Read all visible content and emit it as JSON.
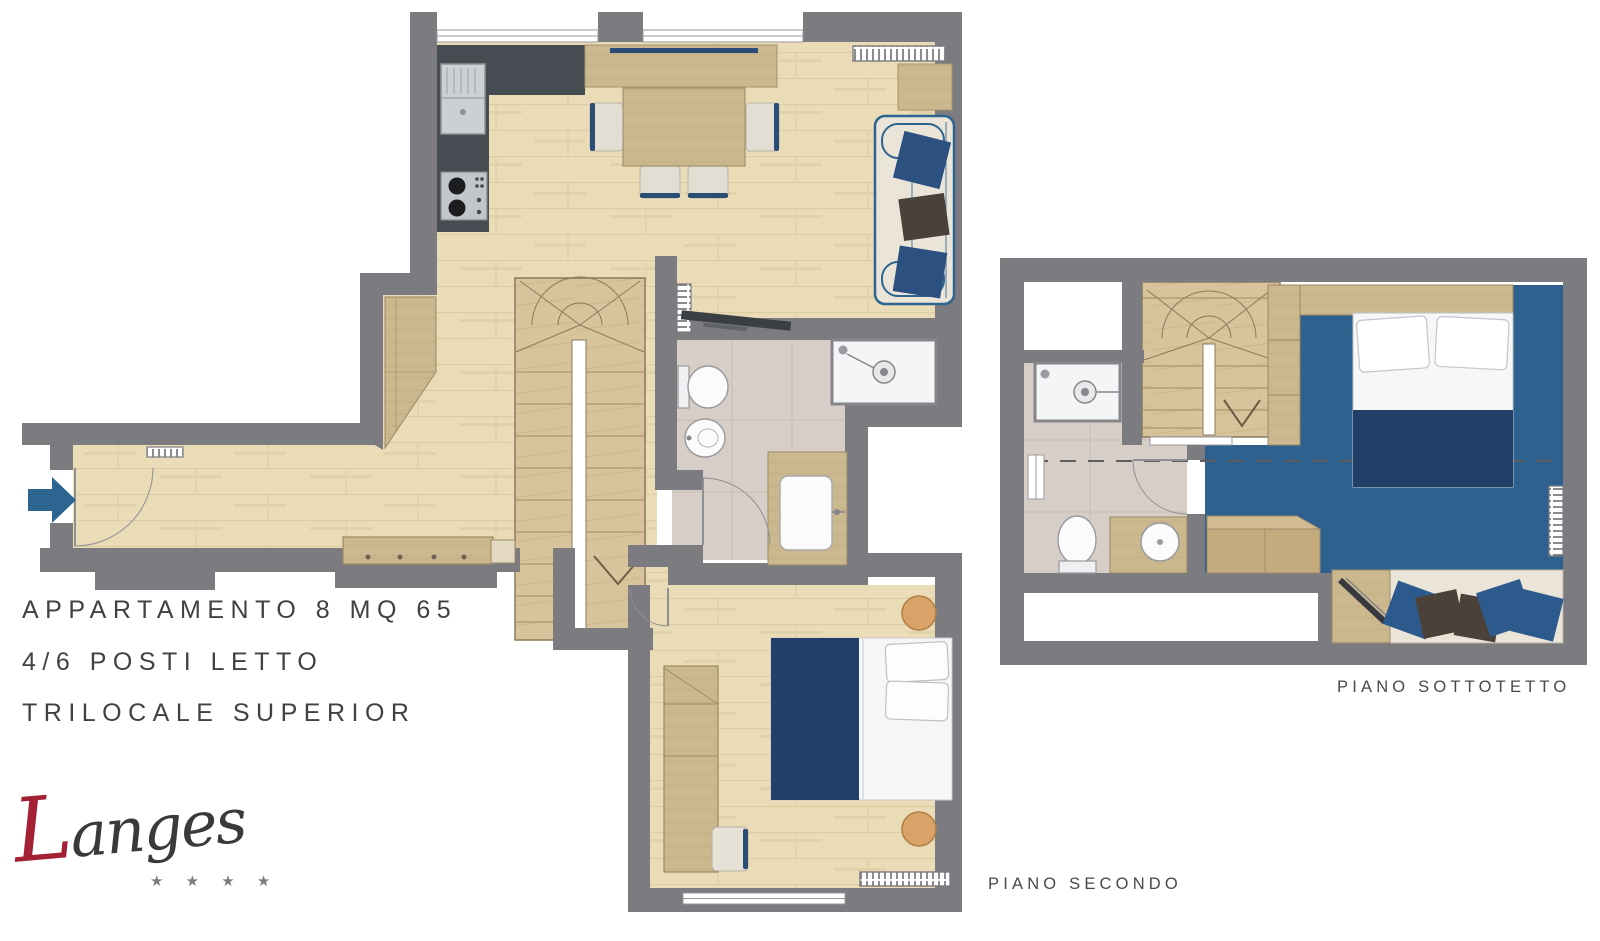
{
  "title": {
    "line1": "APPARTAMENTO 8 MQ 65",
    "line2": "4/6 POSTI LETTO",
    "line3": "TRILOCALE SUPERIOR"
  },
  "captions": {
    "piano_secondo": "PIANO SECONDO",
    "piano_sottotetto": "PIANO SOTTOTETTO"
  },
  "logo": {
    "initial": "L",
    "rest": "anges",
    "stars": "★ ★ ★ ★"
  },
  "palette": {
    "wall_gray": "#7b7b80",
    "kitchen_counter_dark": "#474b52",
    "wood_floor": "#e9dcb6",
    "stairs_wood": "#d8c49c",
    "furniture_wood": "#cbb88f",
    "bathroom_floor": "#d7cec7",
    "attic_floor_blue": "#2f618e",
    "navy_textile": "#223f69",
    "accent_blue": "#2d6591",
    "cream_upholstery": "#ebe5d9",
    "pillow_dark": "#4a4138",
    "stool_tan": "#d8a268",
    "logo_red": "#a32035",
    "text_dark": "#414144"
  }
}
